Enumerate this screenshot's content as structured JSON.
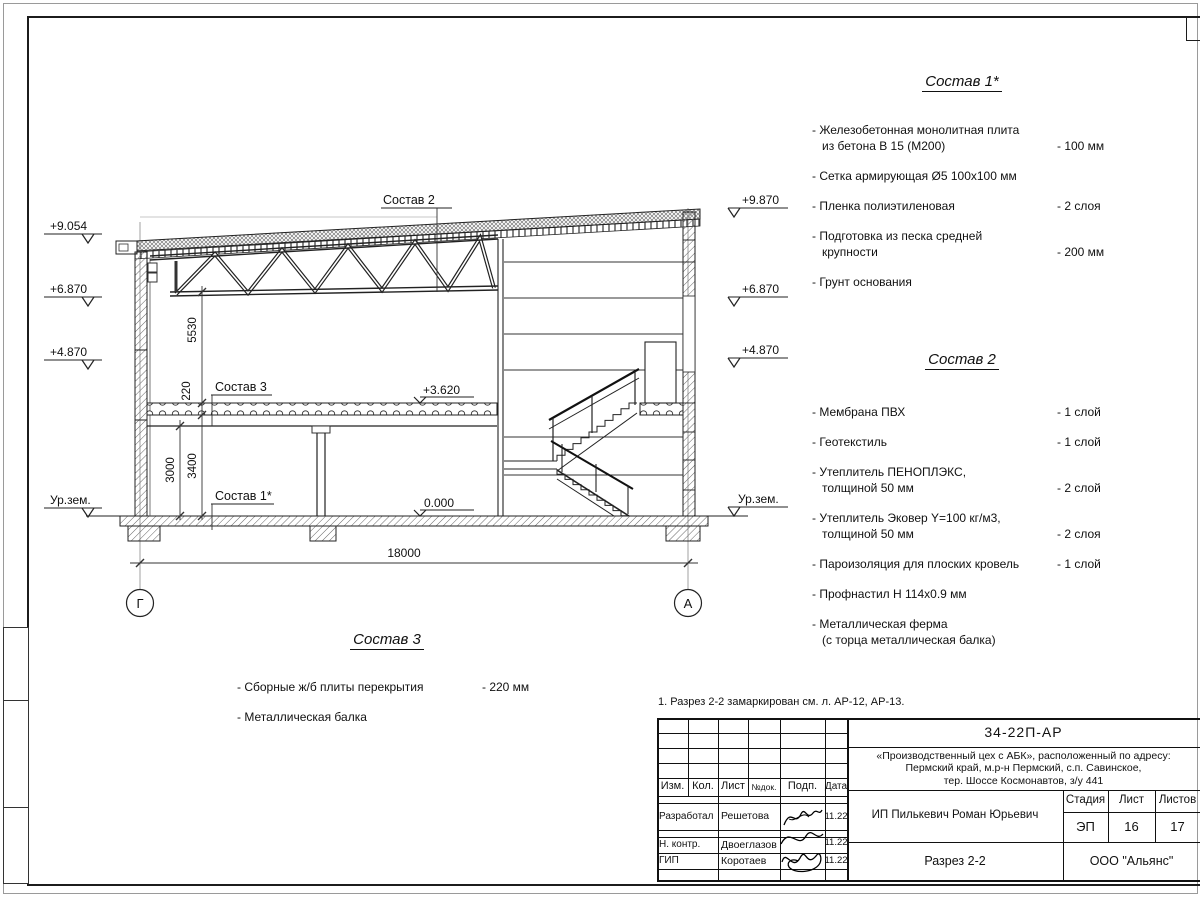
{
  "sheet": {
    "note": "1. Разрез 2-2 замаркирован см. л. АР-12, АР-13."
  },
  "drawing": {
    "elev_left": [
      "+9.054",
      "+6.870",
      "+4.870",
      "Ур.зем."
    ],
    "elev_right": [
      "+9.870",
      "+6.870",
      "+4.870",
      "Ур.зем."
    ],
    "levels": {
      "floor2": "+3.620",
      "floor1": "0.000"
    },
    "refs": {
      "sostav1": "Состав 1*",
      "sostav2": "Состав 2",
      "sostav3": "Состав 3"
    },
    "dims": {
      "truss_height": "5530",
      "slab": "220",
      "beam_clear": "3000",
      "floor_clear": "3400",
      "span": "18000"
    },
    "axes": {
      "left": "Г",
      "right": "А"
    }
  },
  "lists": {
    "sostav1": {
      "title": "Состав 1*",
      "items": [
        {
          "line1": "- Железобетонная  монолитная плита",
          "line2": "из бетона В 15 (М200)",
          "value": "- 100 мм"
        },
        {
          "line1": "- Сетка армирующая Ø5 100х100 мм"
        },
        {
          "line1": "- Пленка полиэтиленовая",
          "value": "-  2 слоя"
        },
        {
          "line1": "- Подготовка из песка средней",
          "line2": "крупности",
          "value": "- 200 мм"
        },
        {
          "line1": "- Грунт основания"
        }
      ]
    },
    "sostav2": {
      "title": "Состав 2",
      "items": [
        {
          "line1": "- Мембрана ПВХ",
          "value": "- 1 слой"
        },
        {
          "line1": "- Геотекстиль",
          "value": "- 1 слой"
        },
        {
          "line1": "- Утеплитель ПЕНОПЛЭКС,",
          "line2": "толщиной 50 мм",
          "value": "- 2 слой"
        },
        {
          "line1": "- Утеплитель Эковер Y=100 кг/м3,",
          "line2": "толщиной 50 мм",
          "value": "- 2 слоя"
        },
        {
          "line1": "- Пароизоляция для плоских кровель",
          "value": "- 1 слой"
        },
        {
          "line1": "- Профнастил Н 114х0.9 мм"
        },
        {
          "line1": "- Металлическая ферма",
          "line2": "(с торца металлическая балка)"
        }
      ]
    },
    "sostav3": {
      "title": "Состав 3",
      "items": [
        {
          "line1": "- Сборные ж/б  плиты перекрытия",
          "value": "- 220 мм"
        },
        {
          "line1": "- Металлическая балка"
        }
      ]
    }
  },
  "stamp": {
    "doc_code": "34-22П-АР",
    "object": {
      "line1": "«Производственный цех с АБК», расположенный по адресу:",
      "line2": "Пермский край, м.р-н Пермский, с.п. Савинское,",
      "line3": "тер. Шоссе Космонавтов, з/у 441"
    },
    "head": {
      "izm": "Изм.",
      "kol": "Кол.",
      "list": "Лист",
      "ndok": "№док.",
      "podp": "Подп.",
      "data": "Дата"
    },
    "rows": [
      {
        "role": "Разработал",
        "name": "Решетова",
        "date": "11.22"
      },
      {
        "role": "Н. контр.",
        "name": "Двоеглазов",
        "date": "11.22"
      },
      {
        "role": "ГИП",
        "name": "Коротаев",
        "date": "11.22"
      }
    ],
    "client": "ИП Пилькевич Роман Юрьевич",
    "stage": {
      "label": "Стадия",
      "value": "ЭП"
    },
    "sheet": {
      "label": "Лист",
      "value": "16"
    },
    "sheets": {
      "label": "Листов",
      "value": "17"
    },
    "title": "Разрез 2-2",
    "company": "ООО \"Альянс\""
  }
}
